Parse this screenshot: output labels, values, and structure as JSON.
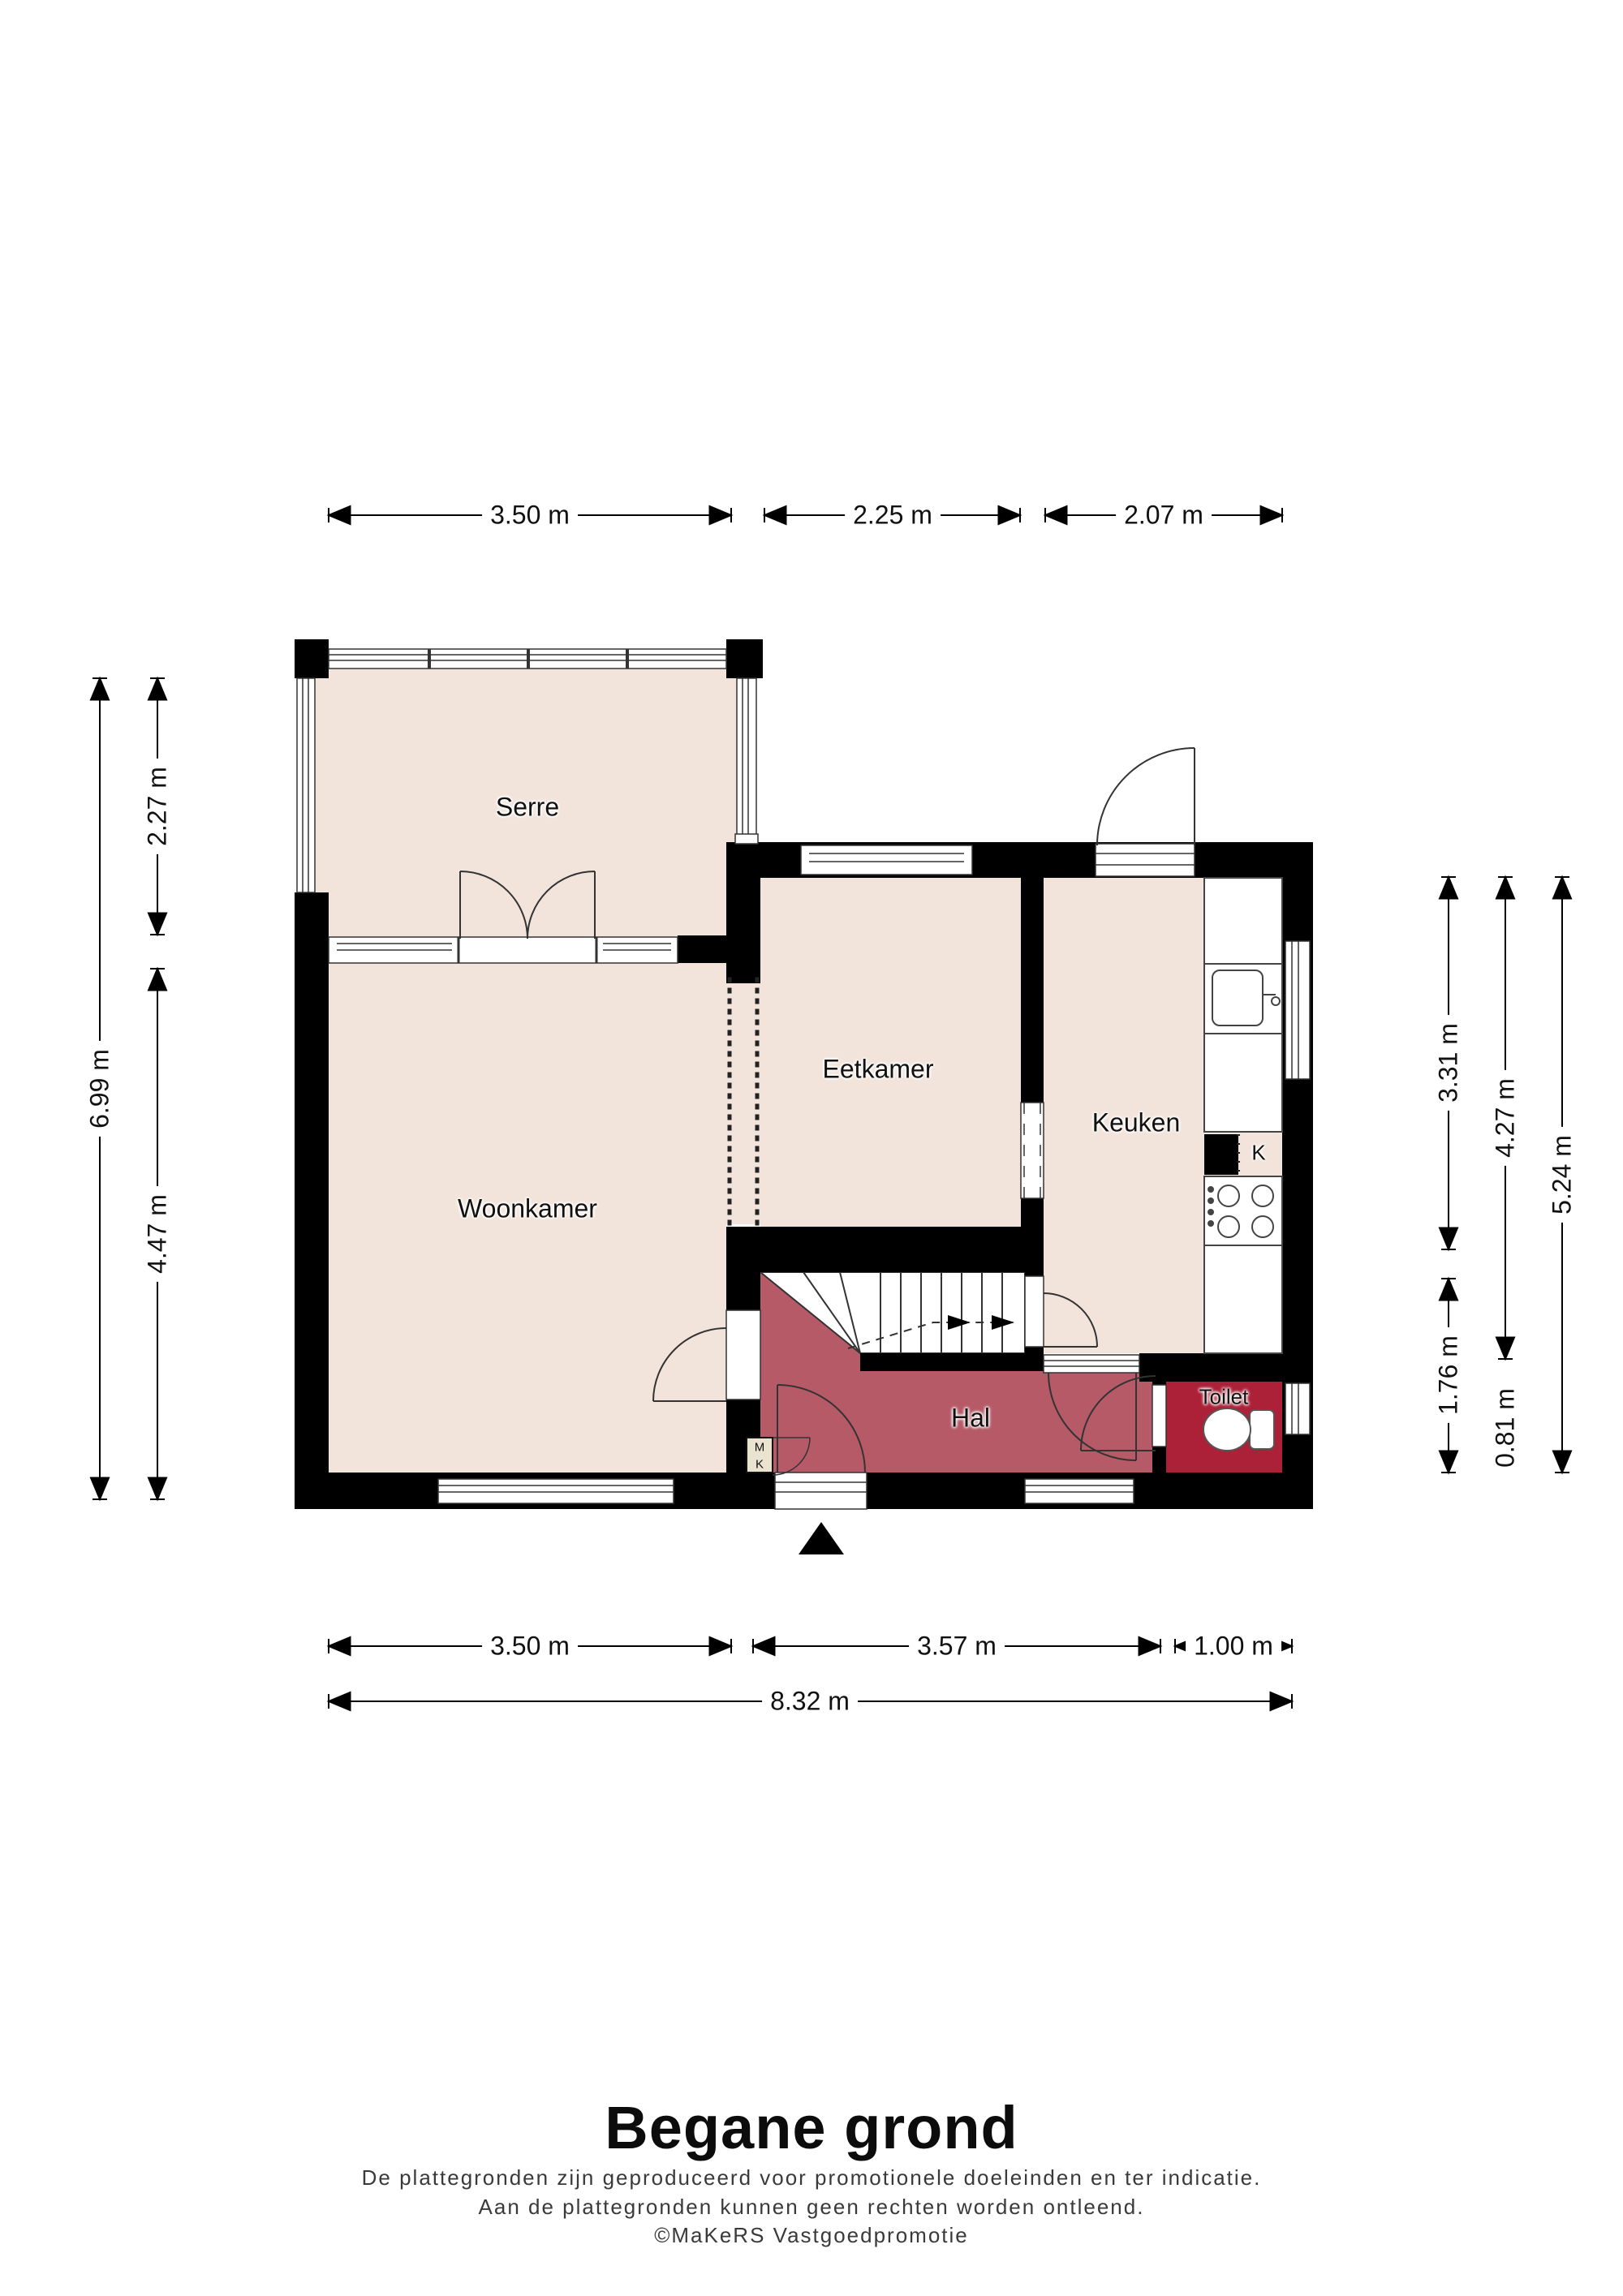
{
  "title": "Begane grond",
  "disclaimer": {
    "line1": "De plattegronden zijn geproduceerd voor promotionele doeleinden en ter indicatie.",
    "line2": "Aan de plattegronden kunnen geen rechten worden ontleend.",
    "line3": "©MaKeRS Vastgoedpromotie"
  },
  "rooms": {
    "serre": "Serre",
    "woonkamer": "Woonkamer",
    "eetkamer": "Eetkamer",
    "keuken": "Keuken",
    "hal": "Hal",
    "toilet": "Toilet",
    "kast": "K",
    "meterkast_m": "M",
    "meterkast_k": "K"
  },
  "dimensions": {
    "top": [
      "3.50 m",
      "2.25 m",
      "2.07 m"
    ],
    "left": [
      "2.27 m",
      "4.47 m",
      "6.99 m"
    ],
    "right": [
      "3.31 m",
      "1.76 m",
      "4.27 m",
      "0.81 m",
      "5.24 m"
    ],
    "bottom": [
      "3.50 m",
      "3.57 m",
      "1.00 m"
    ],
    "total": "8.32 m"
  },
  "colors": {
    "floor": "#f2e4da",
    "hal": "#b75a68",
    "toilet": "#ad2138",
    "wall": "#000000",
    "meterkast": "#eae3cf"
  }
}
